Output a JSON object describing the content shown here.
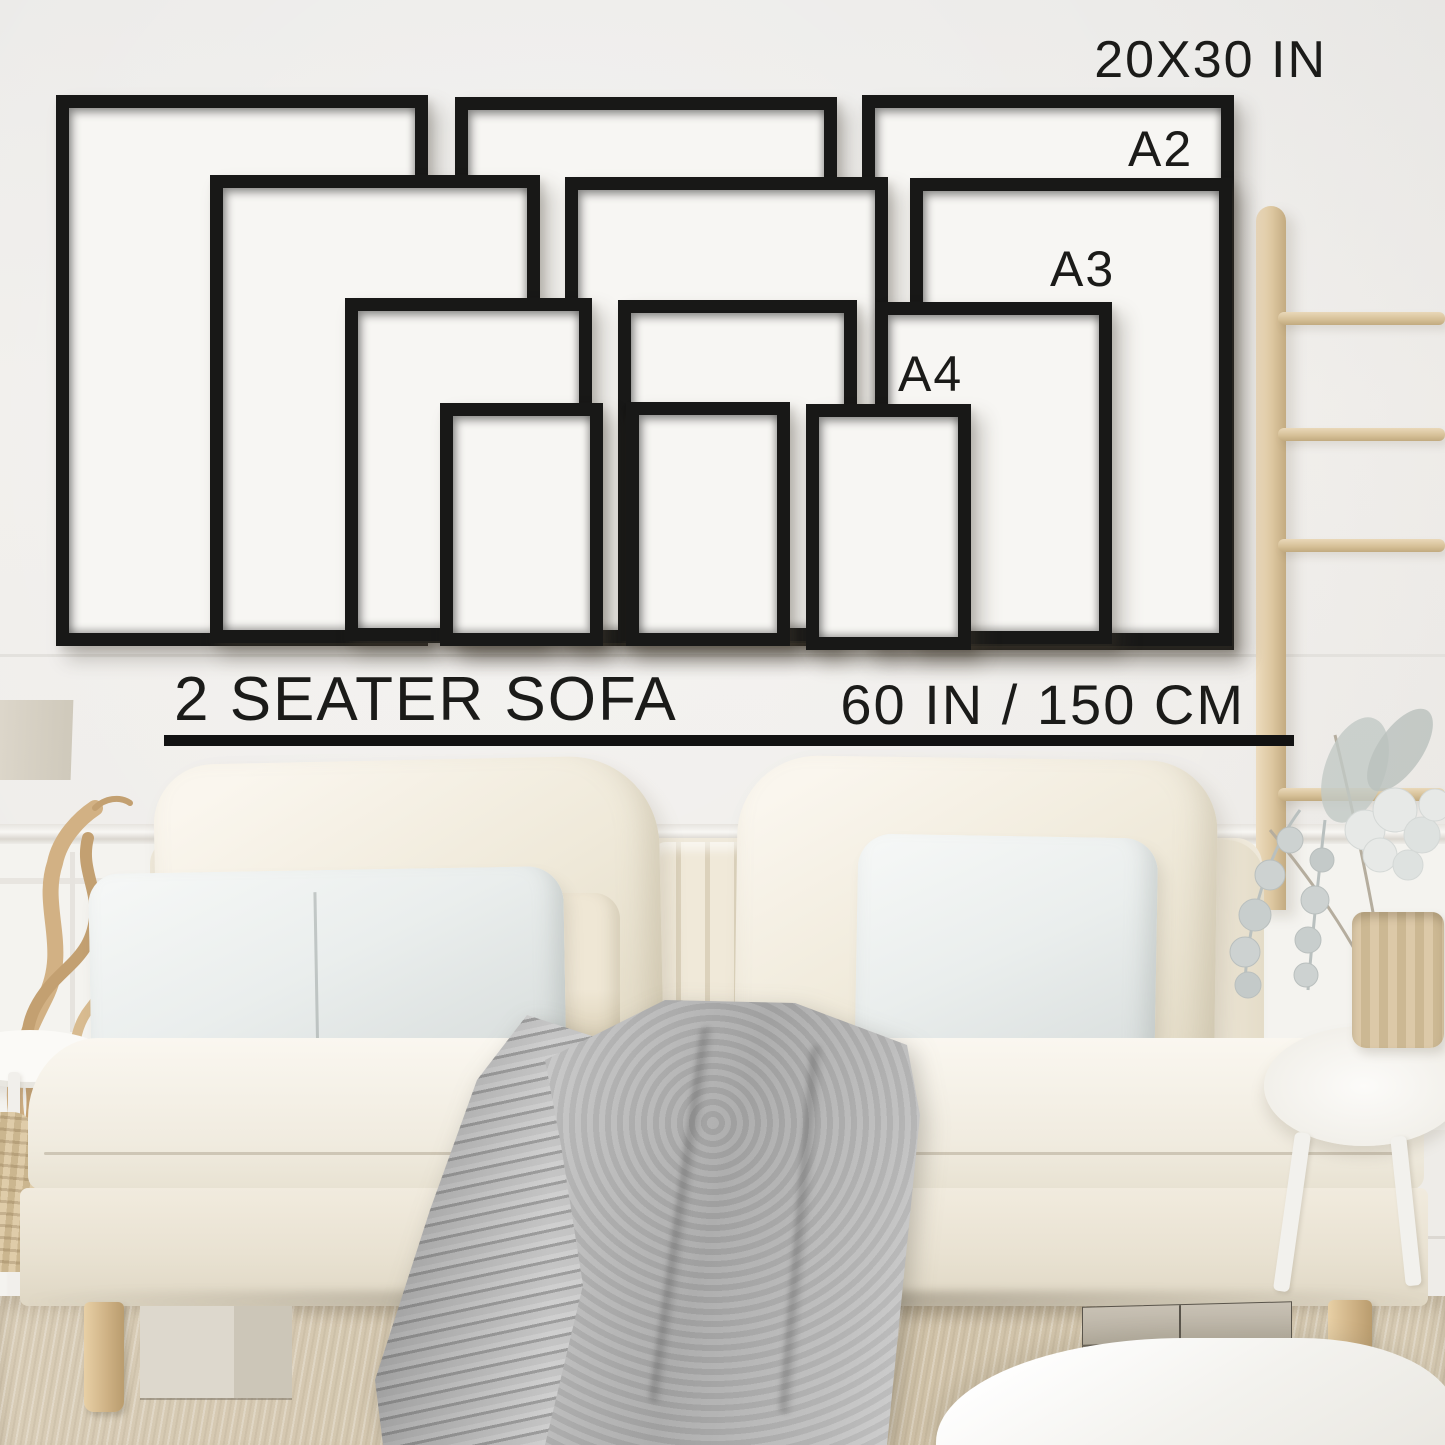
{
  "size_guide": {
    "labels": {
      "largest": "20X30 IN",
      "a2": "A2",
      "a3": "A3",
      "a4": "A4"
    },
    "sofa_label": "2 SEATER SOFA",
    "sofa_width_label": "60 IN / 150 CM",
    "frame_sizes": [
      "20X30 IN",
      "A2",
      "A3",
      "A4"
    ],
    "frames_per_size": 3
  },
  "colors": {
    "frame_black": "#181817",
    "text_black": "#1b1b19",
    "wall": "#f0eeea",
    "wainscot": "#f4f3ef",
    "ladder_wood": "#dcc69f",
    "sofa_cream": "#efe9db",
    "pillow_linen": "#eaeeed",
    "blanket_gray": "#b7b7b7",
    "carpet_beige": "#d3c6ae",
    "box_taupe": "#bfb7aa"
  }
}
